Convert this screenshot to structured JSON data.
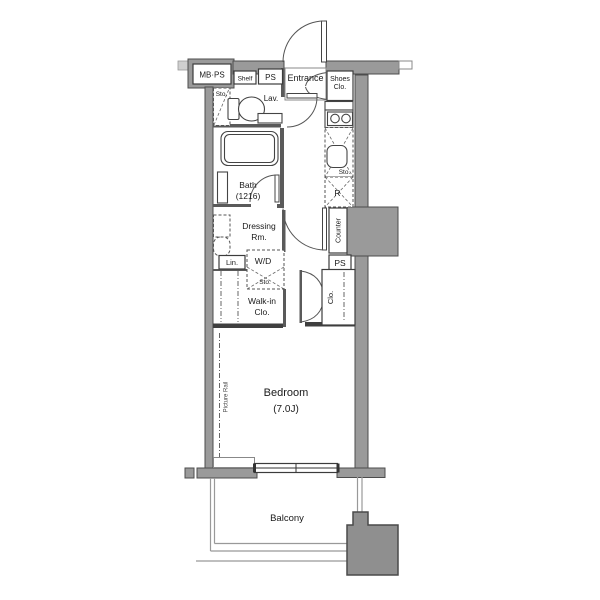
{
  "title": "Apartment floor plan",
  "colors": {
    "background": "#ffffff",
    "wall": "#9a9a9a",
    "wall_border": "#4c4c4c",
    "interior_wall": "#3f3f3f",
    "pillar": "#8f8f8f",
    "line": "#333333",
    "balcony_line": "#999999",
    "text": "#1a1a1a"
  },
  "labels": {
    "mbps": "MB·PS",
    "shelf": "Shelf",
    "ps_top": "PS",
    "entrance": "Entrance",
    "shoes_clo": [
      "Shoes",
      "Clo."
    ],
    "sto_lav": "Sto.",
    "lav": "Lav.",
    "bath": [
      "Bath",
      "(1216)"
    ],
    "sto_kitchen": "Sto.",
    "fridge": "R",
    "counter": "Counter",
    "ps_mid": "PS",
    "dressing": [
      "Dressing",
      "Rm."
    ],
    "lin": "Lin.",
    "wd": "W/D",
    "sto_wd": "Sto.",
    "walk_in_clo": [
      "Walk-in",
      "Clo."
    ],
    "clo": "Clo.",
    "bedroom": [
      "Bedroom",
      "(7.0J)"
    ],
    "picture_rail": "Picture Rail",
    "balcony": "Balcony"
  }
}
